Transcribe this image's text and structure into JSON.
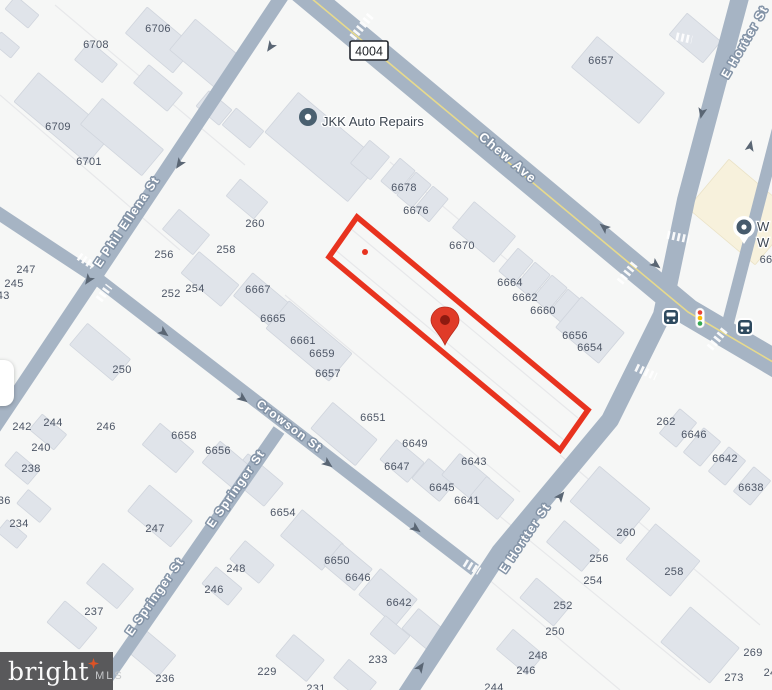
{
  "map": {
    "bg": "#F6F7F6",
    "road_color": "#A6B4C4",
    "road_center_line": "#E7DA8C",
    "building_fill": "#E0E4EA",
    "building_stroke": "#D0D5DD",
    "commercial_fill": "#F7F1DC",
    "label_stroke": "#8494A7",
    "number_color": "#4C5565",
    "accent_red": "#E8331F",
    "pin_red": "#E03B28",
    "pin_core": "#8E1A10",
    "roads": [
      {
        "name": "Chew Ave",
        "path": "M 299,-12 L 688,312 L 790,372",
        "width": 27,
        "center_line": true
      },
      {
        "name": "E Phil Ellena St",
        "path": "M 286,-10 L 95,277 L -14,440",
        "width": 14
      },
      {
        "name": "Crowson St",
        "path": "M -14,205 L 95,277 L 475,570",
        "width": 13
      },
      {
        "name": "E Springer St",
        "path": "M 279,430 L 94,697",
        "width": 13
      },
      {
        "name": "E Hortter St",
        "path": "M 403,700 L 500,552 L 610,420 L 662,315 L 686,200 L 742,-10",
        "width": 18
      },
      {
        "name": "unnamed-street",
        "path": "M 801,40 L 724,338",
        "width": 12
      }
    ],
    "street_labels": [
      {
        "text": "Chew Ave",
        "x": 505,
        "y": 161,
        "rot": 40,
        "size": 13
      },
      {
        "text": "E Phil Ellena St",
        "x": 130,
        "y": 224,
        "rot": -56,
        "size": 12
      },
      {
        "text": "Crowson St",
        "x": 287,
        "y": 429,
        "rot": 37,
        "size": 12
      },
      {
        "text": "E Springer St",
        "x": 239,
        "y": 491,
        "rot": -55,
        "size": 12
      },
      {
        "text": "E Springer St",
        "x": 158,
        "y": 599,
        "rot": -55,
        "size": 12
      },
      {
        "text": "E Hortter St",
        "x": 528,
        "y": 540,
        "rot": -56,
        "size": 12
      },
      {
        "text": "E Hortter St",
        "x": 748,
        "y": 44,
        "rot": -60,
        "size": 12
      }
    ],
    "route_shield": {
      "label": "4004",
      "x": 369,
      "y": 51
    },
    "poi": {
      "label": "JKK Auto Repairs",
      "icon_x": 308,
      "icon_y": 117,
      "text_x": 322,
      "text_y": 122
    },
    "poi_partial": {
      "line1": "W",
      "line2": "W",
      "x": 757,
      "y1": 231,
      "y2": 247,
      "pin_x": 744,
      "pin_y": 227
    },
    "red_parcel": {
      "points": "357,217 588,410 560,450 329,257",
      "dot_x": 365,
      "dot_y": 252
    },
    "pin": {
      "x": 445,
      "y": 322
    },
    "transit": {
      "bus_stops": [
        [
          671,
          317
        ],
        [
          745,
          327
        ]
      ],
      "traffic_light": {
        "x": 700,
        "y": 318
      }
    },
    "house_numbers": [
      [
        96,
        44,
        "6708"
      ],
      [
        158,
        28,
        "6706"
      ],
      [
        58,
        126,
        "6709"
      ],
      [
        89,
        161,
        "6701"
      ],
      [
        601,
        60,
        "6657"
      ],
      [
        404,
        187,
        "6678"
      ],
      [
        416,
        210,
        "6676"
      ],
      [
        462,
        245,
        "6670"
      ],
      [
        510,
        282,
        "6664"
      ],
      [
        525,
        297,
        "6662"
      ],
      [
        543,
        310,
        "6660"
      ],
      [
        575,
        335,
        "6656"
      ],
      [
        590,
        347,
        "6654"
      ],
      [
        258,
        289,
        "6667"
      ],
      [
        273,
        318,
        "6665"
      ],
      [
        303,
        340,
        "6661"
      ],
      [
        322,
        353,
        "6659"
      ],
      [
        328,
        373,
        "6657"
      ],
      [
        255,
        223,
        "260"
      ],
      [
        226,
        249,
        "258"
      ],
      [
        164,
        254,
        "256"
      ],
      [
        195,
        288,
        "254"
      ],
      [
        171,
        293,
        "252"
      ],
      [
        26,
        269,
        "247"
      ],
      [
        14,
        283,
        "245"
      ],
      [
        0,
        295,
        "243"
      ],
      [
        122,
        369,
        "250"
      ],
      [
        22,
        426,
        "242"
      ],
      [
        53,
        422,
        "244"
      ],
      [
        106,
        426,
        "246"
      ],
      [
        41,
        447,
        "240"
      ],
      [
        31,
        468,
        "238"
      ],
      [
        1,
        500,
        "236"
      ],
      [
        19,
        523,
        "234"
      ],
      [
        184,
        435,
        "6658"
      ],
      [
        218,
        450,
        "6656"
      ],
      [
        373,
        417,
        "6651"
      ],
      [
        415,
        443,
        "6649"
      ],
      [
        397,
        466,
        "6647"
      ],
      [
        474,
        461,
        "6643"
      ],
      [
        442,
        487,
        "6645"
      ],
      [
        467,
        500,
        "6641"
      ],
      [
        283,
        512,
        "6654"
      ],
      [
        337,
        560,
        "6650"
      ],
      [
        358,
        577,
        "6646"
      ],
      [
        399,
        602,
        "6642"
      ],
      [
        155,
        528,
        "247"
      ],
      [
        94,
        611,
        "237"
      ],
      [
        165,
        678,
        "236"
      ],
      [
        236,
        568,
        "248"
      ],
      [
        214,
        589,
        "246"
      ],
      [
        267,
        671,
        "229"
      ],
      [
        378,
        659,
        "233"
      ],
      [
        316,
        688,
        "231"
      ],
      [
        494,
        687,
        "244"
      ],
      [
        666,
        421,
        "262"
      ],
      [
        694,
        434,
        "6646"
      ],
      [
        725,
        458,
        "6642"
      ],
      [
        751,
        487,
        "6638"
      ],
      [
        626,
        532,
        "260"
      ],
      [
        599,
        558,
        "256"
      ],
      [
        593,
        580,
        "254"
      ],
      [
        674,
        571,
        "258"
      ],
      [
        563,
        605,
        "252"
      ],
      [
        555,
        631,
        "250"
      ],
      [
        538,
        655,
        "248"
      ],
      [
        526,
        670,
        "246"
      ],
      [
        753,
        652,
        "269"
      ],
      [
        734,
        677,
        "273"
      ],
      [
        766,
        259,
        "66"
      ],
      [
        770,
        672,
        "24"
      ]
    ],
    "buildings": [
      [
        22,
        12,
        30,
        17
      ],
      [
        6,
        45,
        24,
        14
      ],
      [
        96,
        62,
        36,
        24
      ],
      [
        160,
        40,
        62,
        34
      ],
      [
        207,
        55,
        64,
        40
      ],
      [
        158,
        88,
        44,
        24
      ],
      [
        63,
        118,
        96,
        38
      ],
      [
        122,
        137,
        80,
        34
      ],
      [
        214,
        108,
        30,
        20
      ],
      [
        243,
        128,
        36,
        22
      ],
      [
        323,
        147,
        108,
        52
      ],
      [
        186,
        232,
        40,
        26
      ],
      [
        210,
        279,
        52,
        28
      ],
      [
        247,
        199,
        36,
        22
      ],
      [
        100,
        352,
        56,
        28
      ],
      [
        263,
        301,
        52,
        30
      ],
      [
        309,
        341,
        82,
        36
      ],
      [
        370,
        160,
        26,
        30
      ],
      [
        398,
        176,
        20,
        30
      ],
      [
        414,
        190,
        20,
        30
      ],
      [
        431,
        204,
        20,
        30
      ],
      [
        484,
        232,
        54,
        34
      ],
      [
        516,
        266,
        20,
        30
      ],
      [
        533,
        280,
        20,
        30
      ],
      [
        550,
        293,
        20,
        30
      ],
      [
        566,
        307,
        20,
        30
      ],
      [
        590,
        330,
        56,
        40
      ],
      [
        618,
        80,
        88,
        40
      ],
      [
        695,
        38,
        44,
        28
      ],
      [
        344,
        434,
        58,
        34
      ],
      [
        402,
        461,
        36,
        26
      ],
      [
        434,
        480,
        36,
        26
      ],
      [
        466,
        477,
        40,
        28
      ],
      [
        492,
        498,
        36,
        26
      ],
      [
        256,
        480,
        46,
        30
      ],
      [
        312,
        540,
        54,
        34
      ],
      [
        348,
        567,
        40,
        28
      ],
      [
        388,
        597,
        48,
        34
      ],
      [
        424,
        630,
        36,
        26
      ],
      [
        300,
        658,
        40,
        28
      ],
      [
        355,
        680,
        36,
        24
      ],
      [
        160,
        516,
        56,
        34
      ],
      [
        110,
        586,
        40,
        26
      ],
      [
        72,
        625,
        42,
        28
      ],
      [
        150,
        652,
        44,
        28
      ],
      [
        168,
        448,
        44,
        28
      ],
      [
        228,
        466,
        44,
        28
      ],
      [
        48,
        432,
        32,
        20
      ],
      [
        22,
        468,
        30,
        18
      ],
      [
        34,
        506,
        30,
        18
      ],
      [
        12,
        534,
        26,
        16
      ],
      [
        252,
        562,
        38,
        24
      ],
      [
        222,
        586,
        34,
        22
      ],
      [
        390,
        635,
        32,
        24
      ],
      [
        610,
        505,
        66,
        46
      ],
      [
        573,
        546,
        46,
        28
      ],
      [
        663,
        560,
        58,
        46
      ],
      [
        545,
        602,
        44,
        26
      ],
      [
        520,
        652,
        40,
        26
      ],
      [
        700,
        645,
        64,
        46
      ],
      [
        678,
        428,
        22,
        32
      ],
      [
        702,
        447,
        22,
        32
      ],
      [
        727,
        466,
        22,
        32
      ],
      [
        752,
        486,
        22,
        32
      ]
    ],
    "commercial_building": {
      "cx": 742,
      "cy": 212,
      "w": 88,
      "h": 64,
      "rot": 40
    },
    "lot_lines": [
      [
        333,
        248,
        565,
        441
      ],
      [
        350,
        228,
        578,
        418
      ],
      [
        390,
        162,
        610,
        346
      ],
      [
        285,
        295,
        520,
        492
      ],
      [
        55,
        5,
        245,
        165
      ],
      [
        0,
        95,
        180,
        250
      ],
      [
        430,
        530,
        620,
        690
      ],
      [
        480,
        500,
        700,
        680
      ],
      [
        560,
        455,
        760,
        625
      ]
    ],
    "crosswalks": [
      [
        362,
        26,
        -51,
        30
      ],
      [
        86,
        261,
        34,
        17
      ],
      [
        104,
        293,
        -53,
        17
      ],
      [
        678,
        237,
        12,
        22
      ],
      [
        628,
        272,
        -51,
        26
      ],
      [
        718,
        338,
        -51,
        26
      ],
      [
        646,
        372,
        25,
        22
      ],
      [
        472,
        567,
        31,
        17
      ],
      [
        684,
        38,
        12,
        16
      ]
    ],
    "arrows": [
      [
        271,
        46,
        124
      ],
      [
        180,
        163,
        124
      ],
      [
        89,
        279,
        124
      ],
      [
        163,
        332,
        37
      ],
      [
        242,
        398,
        37
      ],
      [
        327,
        463,
        37
      ],
      [
        415,
        528,
        37
      ],
      [
        605,
        228,
        219
      ],
      [
        655,
        264,
        39
      ],
      [
        702,
        112,
        102
      ],
      [
        750,
        147,
        -78
      ],
      [
        420,
        668,
        -56
      ],
      [
        560,
        497,
        -52
      ]
    ]
  },
  "watermark": {
    "brand": "bright",
    "suffix": "MLS"
  }
}
